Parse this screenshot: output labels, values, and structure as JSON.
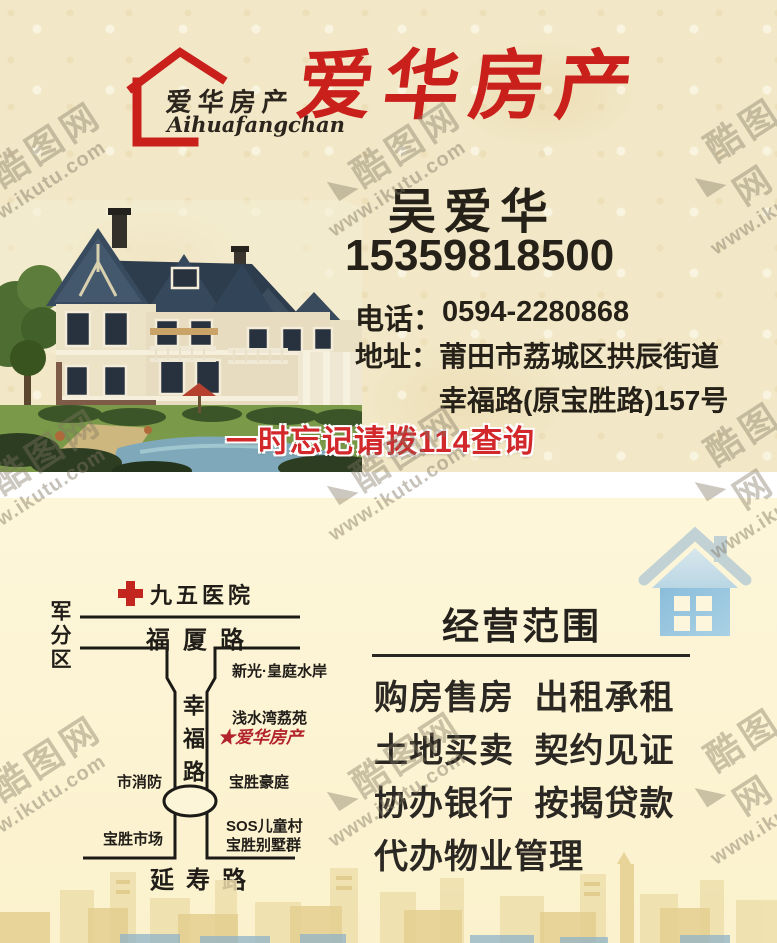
{
  "brand": {
    "logo_text": "爱华房产",
    "logo_subtext": "Aihuafangchan",
    "title": "爱华房产"
  },
  "contact": {
    "name": "吴爱华",
    "mobile": "15359818500",
    "phone_label": "电话：",
    "phone": "0594-2280868",
    "address_label": "地址：",
    "address_line1": "莆田市荔城区拱辰街道",
    "address_line2": "幸福路(原宝胜路)157号",
    "hotline_note": "一时忘记请拨114查询"
  },
  "map": {
    "hospital": "九五医院",
    "military": "军分区",
    "road_top": "福厦路",
    "road_vertical": "幸福路",
    "road_bottom": "延寿路",
    "poi_xinguang": "新光·皇庭水岸",
    "poi_qianshuiwan": "浅水湾荔苑",
    "poi_aihua": "★爱华房产",
    "poi_fire": "市消防",
    "poi_haoting": "宝胜豪庭",
    "poi_market": "宝胜市场",
    "poi_sos": "SOS儿童村",
    "poi_villas": "宝胜别墅群"
  },
  "business": {
    "heading": "经营范围",
    "items": [
      "购房售房 出租承租",
      "土地买卖 契约见证",
      "协办银行 按揭贷款",
      "代办物业管理"
    ]
  },
  "watermark": {
    "mark": "◣",
    "brand": "酷图网",
    "url": "www.ikutu.com"
  },
  "colors": {
    "accent_red": "#c9201c",
    "hotline_red": "#d2282c",
    "map_poi_red": "#b2242b",
    "house_icon_blue": "#97c2dc",
    "top_bg": "#f2e8c7",
    "bottom_bg": "#fdf5d7",
    "text_black": "#262118"
  }
}
